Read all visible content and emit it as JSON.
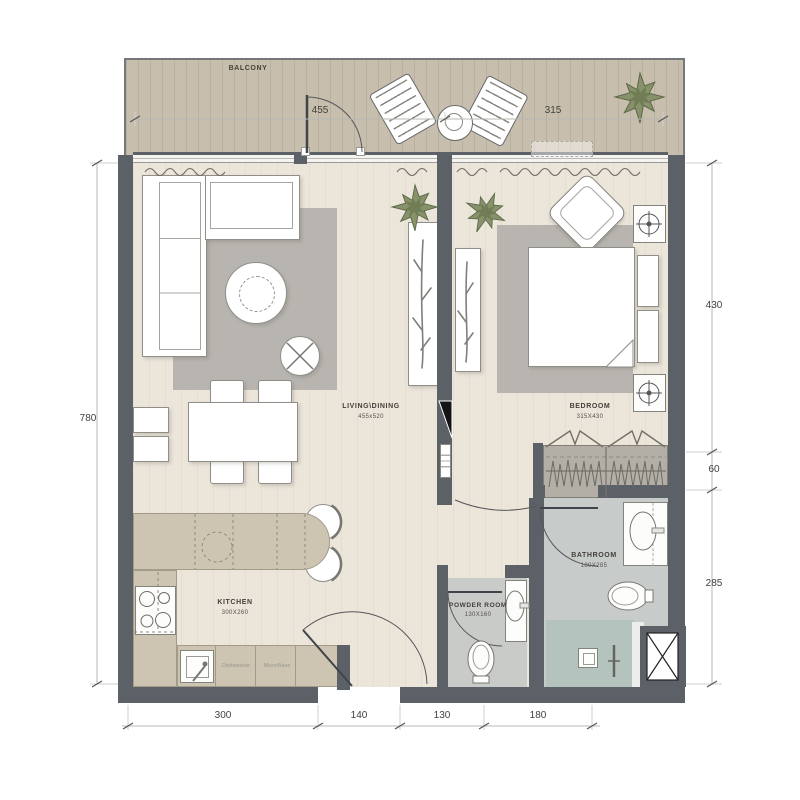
{
  "title": "Apartment floor plan",
  "colors": {
    "wall": "#5b6167",
    "balcony_floor": "#c8bead",
    "interior_floor": "#ece5da",
    "rug": "#b8b5b0",
    "kitchen_counter": "#cdc5b2",
    "bathroom_floor": "#c7cccb",
    "shower_floor": "#b4c3bd",
    "powder_floor": "#c9cbc8",
    "wardrobe": "#b3afa7",
    "plant_green": "#87926b"
  },
  "rooms": {
    "balcony": {
      "label": "BALCONY"
    },
    "living": {
      "label": "LIVING\\DINING",
      "size": "455x520"
    },
    "bedroom": {
      "label": "BEDROOM",
      "size": "315X430"
    },
    "kitchen": {
      "label": "KITCHEN",
      "size": "300X260"
    },
    "powder_room": {
      "label": "POWDER ROOM",
      "size": "130X160"
    },
    "bathroom": {
      "label": "BATHROOM",
      "size": "180X285"
    }
  },
  "appliances": {
    "dishwasher": "Dishwasher",
    "microwave": "MicroWave"
  },
  "dimensions": {
    "top": [
      "455",
      "315"
    ],
    "left": [
      "780"
    ],
    "right": [
      "430",
      "60",
      "285"
    ],
    "bottom": [
      "300",
      "140",
      "130",
      "180"
    ]
  }
}
